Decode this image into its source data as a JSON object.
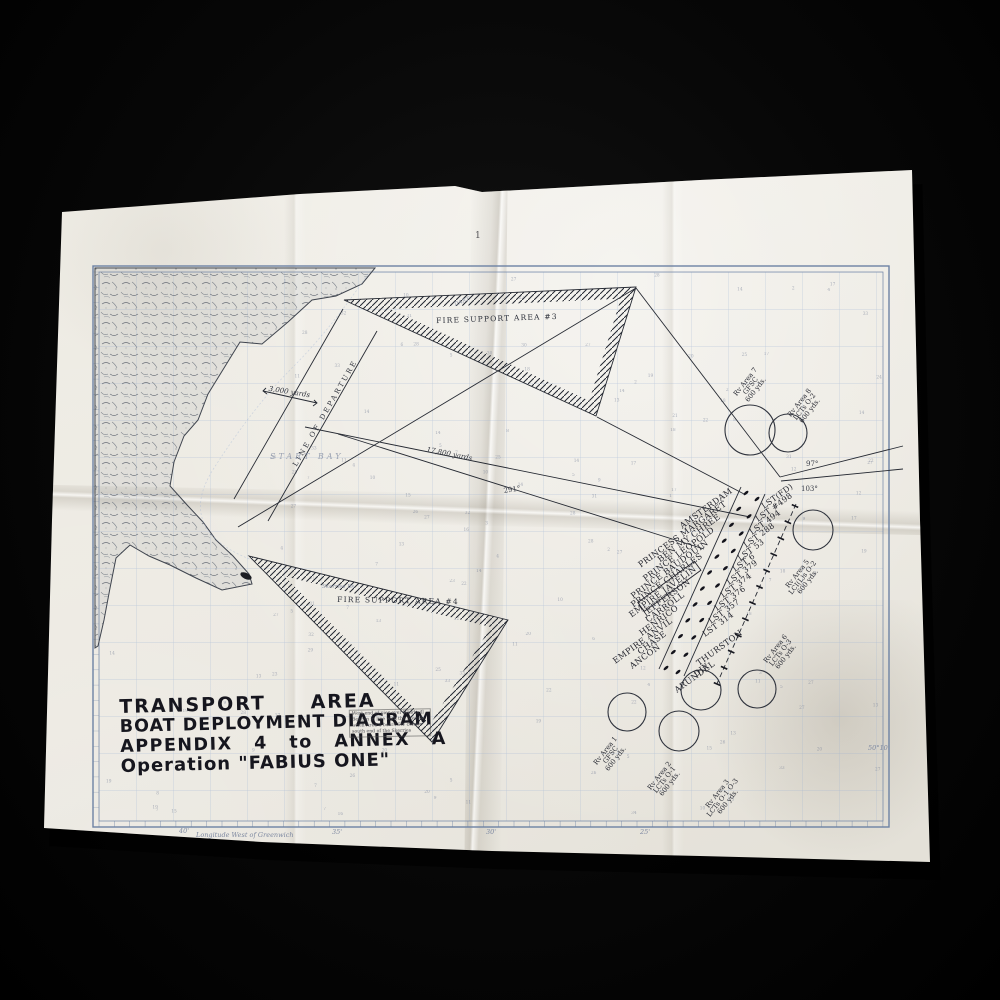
{
  "photo": {
    "backdrop": "#050505",
    "paper": "#ece9e1"
  },
  "title_block": {
    "line1": "TRANSPORT AREA",
    "line2": "BOAT DEPLOYMENT DIAGRAM",
    "line3": "APPENDIX 4 to ANNEX A",
    "line4": "Operation \"FABIUS ONE\""
  },
  "chart": {
    "fire_support_area_3": "FIRE SUPPORT AREA #3",
    "fire_support_area_4": "FIRE SUPPORT AREA #4",
    "line_of_departure": "LINE OF DEPARTURE",
    "dist_short": "3,000 yards",
    "dist_long": "17,800 yards",
    "bearing_291": "291°",
    "bearing_97": "97°",
    "bearing_103": "103°",
    "latitude_label": "50°10'",
    "longitude_caption": "Longitude West of Greenwich",
    "lon_ticks": [
      "40'",
      "35'",
      "30'",
      "25'"
    ],
    "place_start_bay": "START BAY",
    "place_skerries": "Skerries Bk",
    "place_dart": "DART",
    "fold_mark": "1",
    "ships_left": [
      "AMSTERDAM",
      "PRINCESS MARGARET",
      "BEN MY CHREE",
      "PRINCE LEOPOLD",
      "PRINCE BAUDOUIN",
      "PRINCE CHARLES",
      "EMPIRE JAVELIN",
      "JEFFERSON",
      "CARROLL",
      "HENRICO",
      "EMPIRE ANVIL",
      "CHASE",
      "ANCON"
    ],
    "ships_right": [
      "THURSTON",
      "DIX",
      "ARUNDEL"
    ],
    "lst_column": [
      "LST(FD)",
      "LST #498",
      "LST 494",
      "LST 288",
      "LST 53",
      "LST 6",
      "LST 379",
      "LST 374",
      "LST 376",
      "LST 357",
      "LST 314"
    ],
    "rv_areas": [
      {
        "title": "Rv Area 7",
        "craft": "GFSC",
        "dist": "600 yds."
      },
      {
        "title": "Rv Area 8",
        "craft": "LCTs O-2",
        "dist": "600 yds."
      },
      {
        "title": "Rv Area 5",
        "craft": "LCI(L)s O-2",
        "dist": "600 yds."
      },
      {
        "title": "Rv Area 6",
        "craft": "LCTs O-3",
        "dist": "600 yds."
      },
      {
        "title": "Rv Area 1",
        "craft": "GFSC",
        "dist": "600 yds."
      },
      {
        "title": "Rv Area 2",
        "craft": "LCTs O-1",
        "dist": "600 yds."
      },
      {
        "title": "Rv Area 3",
        "craft": "LCTs O-1 O-3",
        "dist": "600 yds."
      }
    ],
    "note_lines": [
      "West end of pier over Windmill",
      "Beacon in line with the Steeple",
      "when Area 4 bears SW corner",
      "south end of the Skerries"
    ]
  }
}
